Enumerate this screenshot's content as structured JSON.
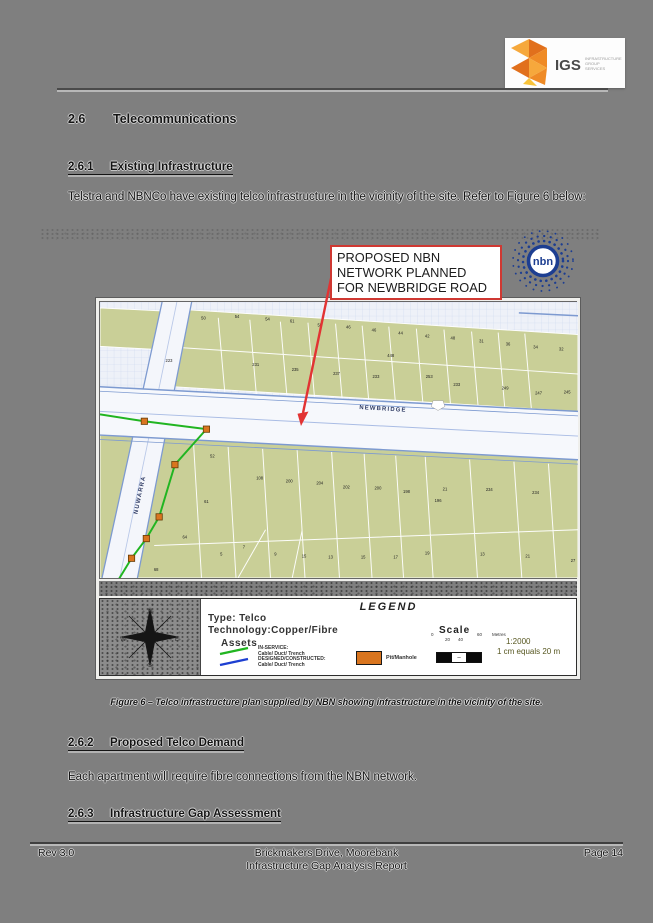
{
  "header": {
    "logo": {
      "acronym": "IGS",
      "subtext": [
        "INFRASTRUCTURE",
        "GROUP",
        "SERVICES"
      ]
    }
  },
  "content": {
    "s26": {
      "number": "2.6",
      "title": "Telecommunications"
    },
    "s261": {
      "number": "2.6.1",
      "title": "Existing Infrastructure"
    },
    "para_existing": "Telstra and NBNCo have existing telco infrastructure in the vicinity of the site. Refer to Figure 6 below:",
    "s262": {
      "number": "2.6.2",
      "title": "Proposed Telco Demand"
    },
    "para_demand": "Each apartment will require fibre connections from the NBN network.",
    "s263": {
      "number": "2.6.3",
      "title": "Infrastructure Gap Assessment"
    }
  },
  "figure": {
    "callout": {
      "lines": [
        "PROPOSED NBN",
        "NETWORK PLANNED",
        "FOR NEWBRIDGE ROAD"
      ]
    },
    "nbn_logo_text": "nbn",
    "caption": "Figure 6 – Telco infrastructure plan supplied by NBN showing infrastructure in the vicinity of the site.",
    "map": {
      "road_labels": [
        {
          "text": "NEWBRIDGE",
          "x": 287,
          "y": 110,
          "rotate": 3.5
        },
        {
          "text": "NUWARRA",
          "x": 42,
          "y": 196,
          "rotate": -78
        }
      ],
      "lot_numbers": [
        {
          "t": "50",
          "x": 105,
          "y": 18
        },
        {
          "t": "54",
          "x": 139,
          "y": 16
        },
        {
          "t": "54",
          "x": 170,
          "y": 19
        },
        {
          "t": "61",
          "x": 195,
          "y": 21
        },
        {
          "t": "58",
          "x": 223,
          "y": 25
        },
        {
          "t": "46",
          "x": 252,
          "y": 27
        },
        {
          "t": "46",
          "x": 278,
          "y": 30
        },
        {
          "t": "44",
          "x": 305,
          "y": 33
        },
        {
          "t": "42",
          "x": 332,
          "y": 36
        },
        {
          "t": "48",
          "x": 358,
          "y": 38
        },
        {
          "t": "31",
          "x": 387,
          "y": 41
        },
        {
          "t": "36",
          "x": 414,
          "y": 44
        },
        {
          "t": "34",
          "x": 442,
          "y": 47
        },
        {
          "t": "32",
          "x": 468,
          "y": 49
        },
        {
          "t": "223",
          "x": 70,
          "y": 61
        },
        {
          "t": "231",
          "x": 158,
          "y": 65
        },
        {
          "t": "235",
          "x": 198,
          "y": 70
        },
        {
          "t": "237",
          "x": 240,
          "y": 74
        },
        {
          "t": "233",
          "x": 280,
          "y": 77
        },
        {
          "t": "448",
          "x": 295,
          "y": 56
        },
        {
          "t": "253",
          "x": 334,
          "y": 77
        },
        {
          "t": "233",
          "x": 362,
          "y": 85
        },
        {
          "t": "249",
          "x": 411,
          "y": 89
        },
        {
          "t": "247",
          "x": 445,
          "y": 94
        },
        {
          "t": "245",
          "x": 474,
          "y": 93
        },
        {
          "t": "52",
          "x": 114,
          "y": 158
        },
        {
          "t": "108",
          "x": 162,
          "y": 180
        },
        {
          "t": "200",
          "x": 192,
          "y": 183
        },
        {
          "t": "204",
          "x": 223,
          "y": 185
        },
        {
          "t": "202",
          "x": 250,
          "y": 189
        },
        {
          "t": "200",
          "x": 282,
          "y": 190
        },
        {
          "t": "198",
          "x": 311,
          "y": 194
        },
        {
          "t": "21",
          "x": 350,
          "y": 191
        },
        {
          "t": "196",
          "x": 343,
          "y": 203
        },
        {
          "t": "234",
          "x": 395,
          "y": 192
        },
        {
          "t": "234",
          "x": 442,
          "y": 195
        },
        {
          "t": "61",
          "x": 108,
          "y": 204
        },
        {
          "t": "64",
          "x": 86,
          "y": 240
        },
        {
          "t": "68",
          "x": 57,
          "y": 273
        },
        {
          "t": "5",
          "x": 123,
          "y": 257
        },
        {
          "t": "7",
          "x": 146,
          "y": 250
        },
        {
          "t": "9",
          "x": 178,
          "y": 257
        },
        {
          "t": "15",
          "x": 207,
          "y": 259
        },
        {
          "t": "13",
          "x": 234,
          "y": 260
        },
        {
          "t": "15",
          "x": 267,
          "y": 260
        },
        {
          "t": "17",
          "x": 300,
          "y": 260
        },
        {
          "t": "19",
          "x": 332,
          "y": 256
        },
        {
          "t": "13",
          "x": 388,
          "y": 257
        },
        {
          "t": "21",
          "x": 434,
          "y": 259
        },
        {
          "t": "27",
          "x": 480,
          "y": 264
        }
      ],
      "colors": {
        "parcel_green": "#c9cf97",
        "road_edge_blue": "#7d9ad0",
        "cable_in_service_green": "#21b521",
        "cable_designed_blue": "#1d3fd1",
        "pit_orange": "#d9751f",
        "callout_red": "#cf3832",
        "nbn_blue": "#1d3e91"
      }
    },
    "legend": {
      "title": "LEGEND",
      "type_line": "Type: Telco",
      "tech_line": "Technology:Copper/Fibre",
      "assets_label": "Assets",
      "items": [
        {
          "label1": "IN-SERVICE:",
          "label2": "Cable/ Duct/ Trench"
        },
        {
          "label1": "DESIGNED/CONSTRUCTED:",
          "label2": "Cable/ Duct/ Trench"
        }
      ],
      "pit_label": "Pit/Manhole",
      "scale": {
        "label": "Scale",
        "tick0": "0",
        "tick20": "20",
        "tick40": "40",
        "tick60": "60",
        "units": "Metres",
        "ratio": "1:2000",
        "equiv": "1 cm equals 20 m"
      },
      "compass": {
        "n": "N",
        "e": "E",
        "s": "S",
        "w": "W"
      }
    }
  },
  "footer": {
    "rev": "Rev 3.0",
    "center_line1": "Brickmakers Drive, Moorebank",
    "center_line2": "Infrastructure Gap Analysis Report",
    "page": "Page 14"
  }
}
